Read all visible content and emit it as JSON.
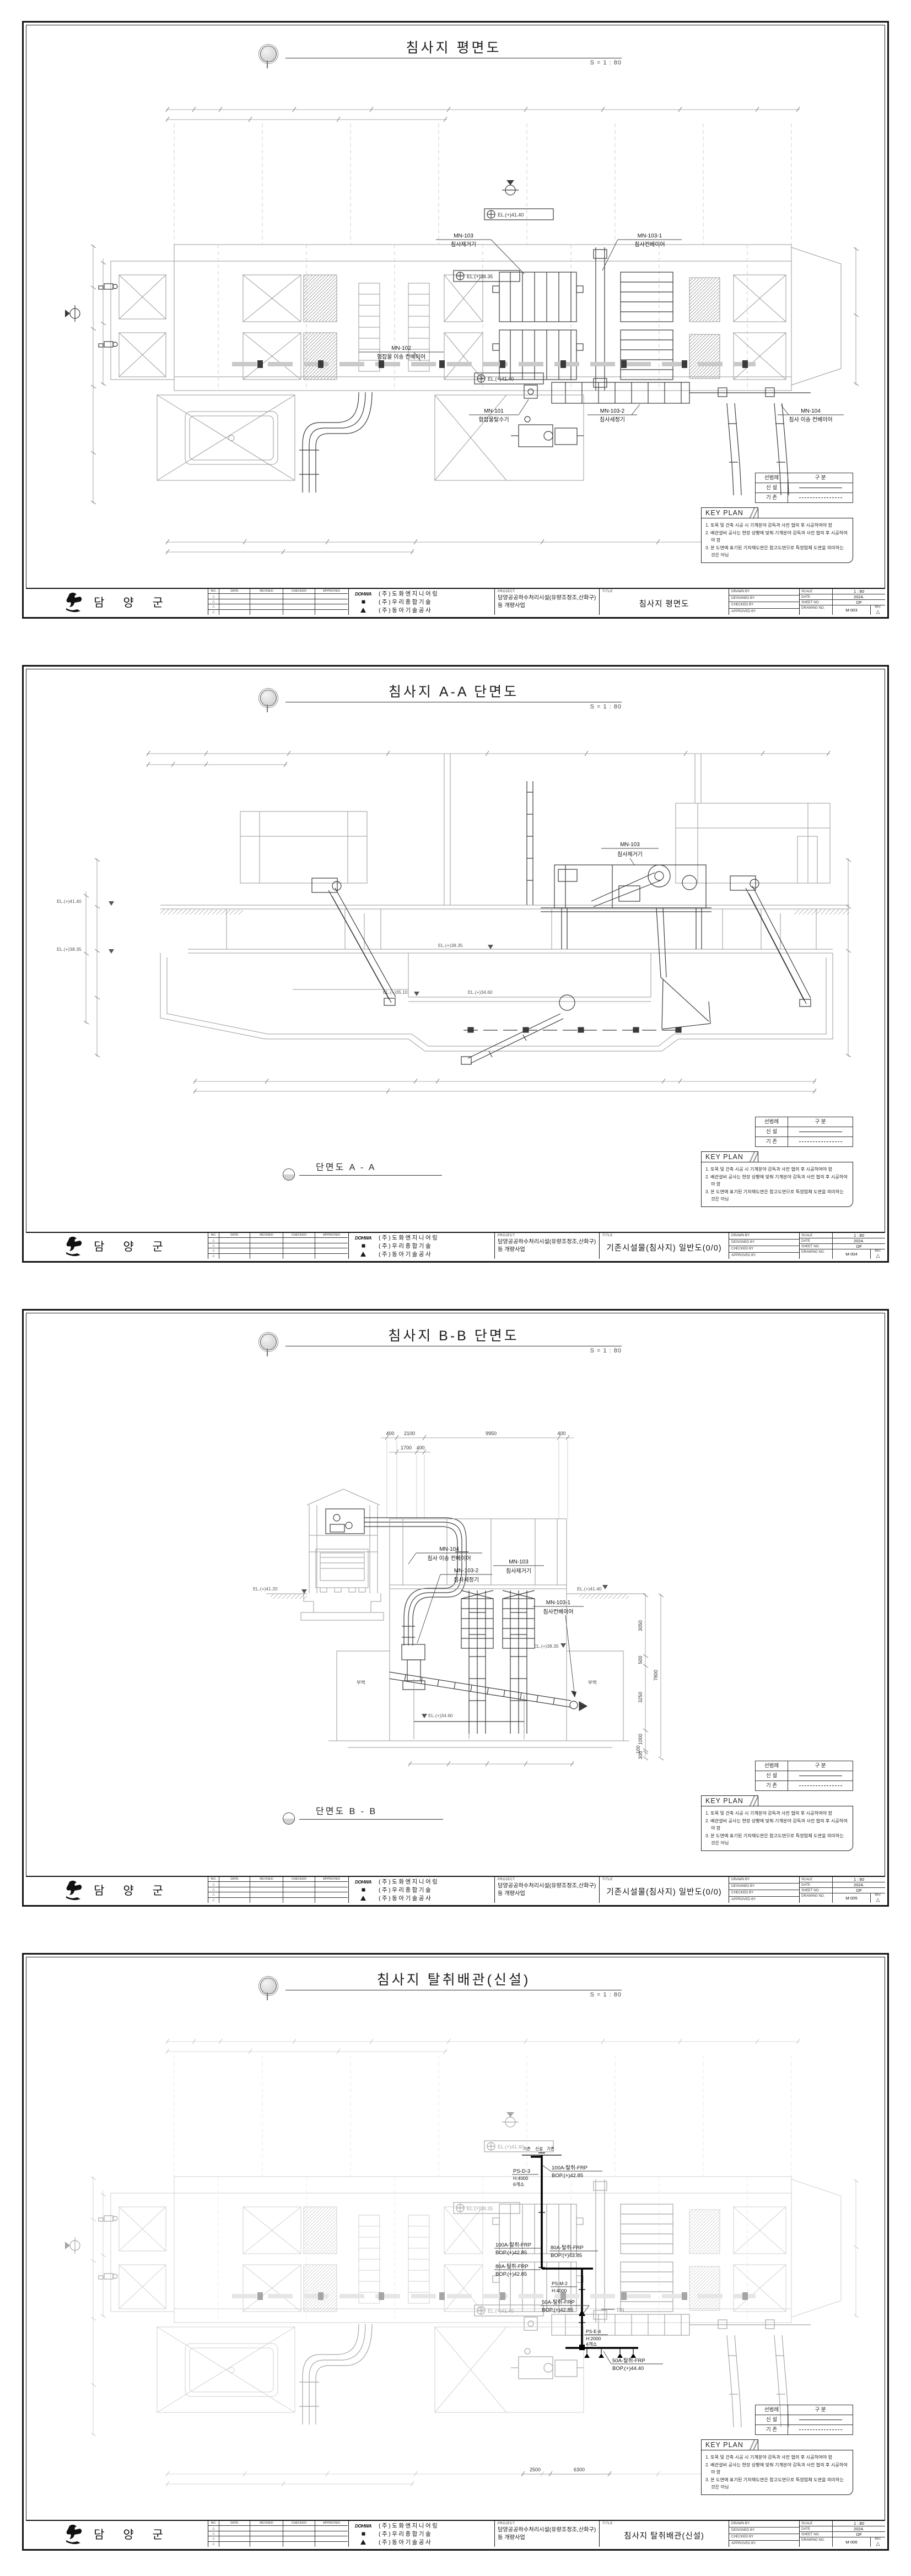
{
  "colors": {
    "paper": "#ffffff",
    "line_dark": "#3a3a3a",
    "line_gray": "#9a9a9a",
    "pipe_new": "#000000"
  },
  "client": {
    "name": "담 양 군"
  },
  "companies": [
    {
      "logo": "DOHWA",
      "name": "(주)도화엔지니어링"
    },
    {
      "name": "(주)우리종합기술"
    },
    {
      "name": "(주)동아기술공사"
    }
  ],
  "project": {
    "label": "PROJECT",
    "name": "담양공공하수처리시설(유량조정조,산화구)등 개량사업"
  },
  "tb": {
    "title_label": "TITLE",
    "drawn_by": "DRAWN BY",
    "designed_by": "DESIGNED BY",
    "checked_by": "CHECKED BY",
    "approved_by": "APPROVED BY",
    "scale_label": "SCALE",
    "scale": "1 : 80",
    "date_label": "DATE",
    "date": "2024.",
    "sheet_no_label": "SHEET NO.",
    "sheet_no": "OF",
    "drawing_no_label": "DRAWING NO.",
    "rev_label": "REV.",
    "rev_mark": "△"
  },
  "revision_table": {
    "cols": [
      "NO.",
      "DATE",
      "REVISED",
      "CHECKED",
      "APPROVED"
    ],
    "row_mark": "△"
  },
  "legend": {
    "col1": "선범례",
    "col2": "구  분",
    "row1": "신  설",
    "row2": "기  존"
  },
  "key_plan": {
    "title": "KEY PLAN",
    "notes": [
      "1. 토목 및 건축 시공 시 기계분야 감독과 사전 협의 후 시공하여야 함",
      "2. 배관설비 공사는 현장 상황에 맞춰 기계분야 감독과 사전 협의 후 시공하여야 함",
      "3. 본 도면에 표기된 기자재도면은 참고도면으로 특정업체 도면을 의미하는 것은 아님"
    ]
  },
  "sheets": [
    {
      "title": "침사지 평면도",
      "scale_note": "S = 1 : 80",
      "block_title": "침사지 평면도",
      "drawing_no": "M-003"
    },
    {
      "title": "침사지 A-A 단면도",
      "scale_note": "S = 1 : 80",
      "block_title": "기존시설물(침사지) 일반도(0/0)",
      "drawing_no": "M-004",
      "caption": "단면도 A - A"
    },
    {
      "title": "침사지 B-B 단면도",
      "scale_note": "S = 1 : 80",
      "block_title": "기존시설물(침사지) 일반도(0/0)",
      "drawing_no": "M-005",
      "caption": "단면도 B - B"
    },
    {
      "title": "침사지 탈취배관(신설)",
      "scale_note": "S = 1 : 80",
      "block_title": "침사지 탈취배관(신설)",
      "drawing_no": "M-006"
    }
  ],
  "plan": {
    "el_top": "EL.(+)41.40",
    "el_mid": "EL.(+)38.35",
    "el_bottom": "EL.(+)41.40",
    "callouts": {
      "c103": {
        "tag": "MN-103",
        "name": "침사제거기"
      },
      "c1031": {
        "tag": "MN-103-1",
        "name": "침사컨베이어"
      },
      "c102": {
        "tag": "MN-102",
        "name": "협잡물 이송 컨베이어"
      },
      "c101": {
        "tag": "MN-101",
        "name": "협잡물탈수기"
      },
      "c1032": {
        "tag": "MN-103-2",
        "name": "침사세정기"
      },
      "c104": {
        "tag": "MN-104",
        "name": "침사 이송 컨베이어"
      }
    }
  },
  "section_a": {
    "el_4140": "EL.(+)41.40",
    "el_3835": "EL.(+)38.35",
    "el_3510": "EL.(+)35.10",
    "el_3460": "EL.(+)34.60",
    "callout": {
      "tag": "MN-103",
      "name": "침사제거기"
    }
  },
  "section_b": {
    "el_4120": "EL.(+)41.20",
    "el_4140": "EL.(+)41.40",
    "el_3835": "EL.(+)38.35",
    "el_3460": "EL.(+)34.60",
    "buttress": "부벽",
    "dims_top": [
      "400",
      "2100",
      "9950",
      "400"
    ],
    "dims_top2": [
      "1700",
      "400"
    ],
    "dims_right": [
      "3050",
      "500",
      "3250",
      "1000",
      "100",
      "300"
    ],
    "dim_total": "7800",
    "callouts": {
      "c104": {
        "tag": "MN-104",
        "name": "침사 이송 컨베이어"
      },
      "c1032": {
        "tag": "MN-103-2",
        "name": "침사세정기"
      },
      "c103": {
        "tag": "MN-103",
        "name": "침사제거기"
      },
      "c1031": {
        "tag": "MN-103-1",
        "name": "침사컨베이어"
      }
    }
  },
  "piping": {
    "markers": [
      "기존",
      "신설",
      "기존"
    ],
    "ps_d3": {
      "tag": "PS-D-3",
      "h": "H:4000",
      "n": "6개소"
    },
    "ps_m2": {
      "tag": "PS-M-2",
      "h": "H:4000"
    },
    "ps_e4": {
      "tag": "PS-E-4",
      "h": "H:2000",
      "n": "4개소"
    },
    "l100_top": {
      "size": "100A-탈취-FRP",
      "bop": "BOP.(+)42.85"
    },
    "l100_mid": {
      "size": "100A-탈취-FRP",
      "bop": "BOP.(+)42.85"
    },
    "l80_a": {
      "size": "80A-탈취-FRP",
      "bop": "BOP.(+)43.85"
    },
    "l80_b": {
      "size": "80A-탈취-FRP",
      "bop": "BOP.(+)42.85"
    },
    "l50_a": {
      "size": "50A-탈취-FRP",
      "bop": "BOP.(+)42.85"
    },
    "l50_b": {
      "size": "50A-탈취-FRP",
      "bop": "BOP.(+)44.40"
    },
    "dn": "DN",
    "dims_bottom": [
      "2500",
      "6300"
    ]
  }
}
